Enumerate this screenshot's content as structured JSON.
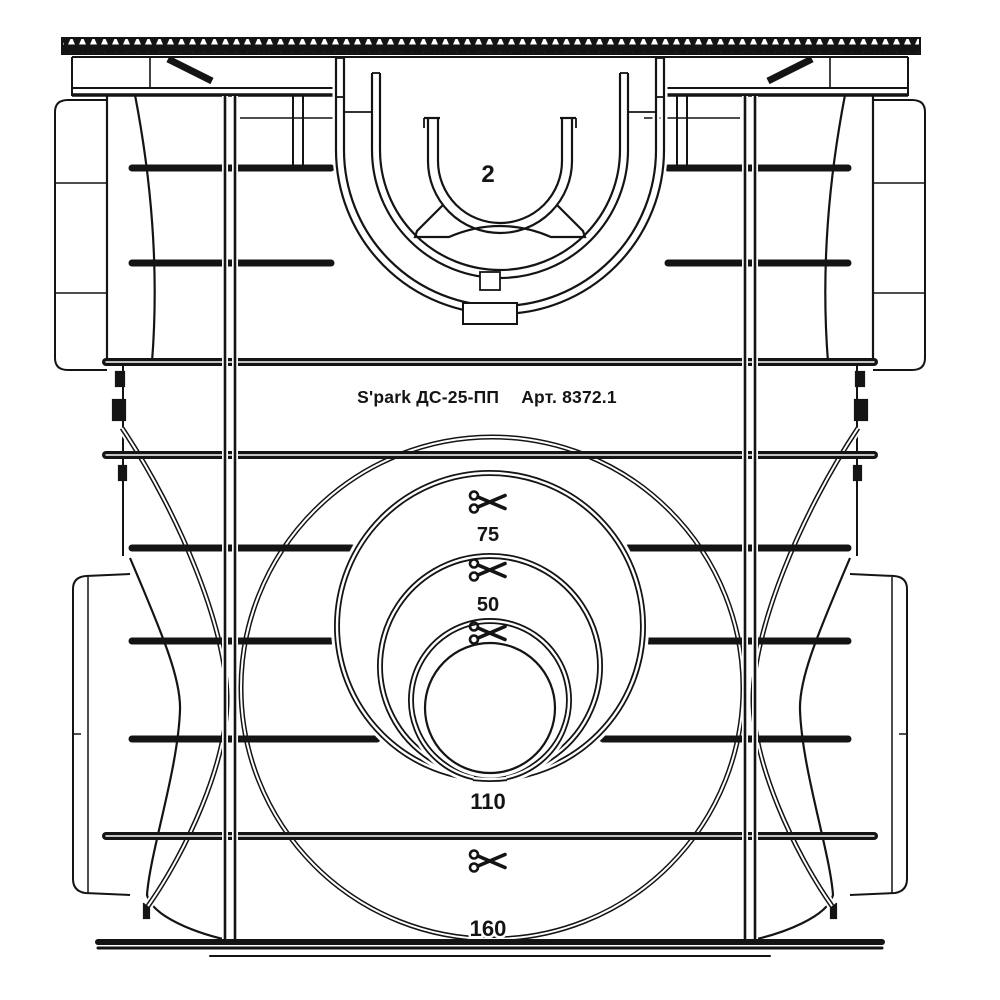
{
  "drawing": {
    "background": "#ffffff",
    "line_color": "#141414",
    "brand_text": "S'park ДС-25-ПП",
    "article_text": "Арт. 8372.1",
    "channel_callout": "2",
    "cut_icon": "scissors",
    "knockouts": {
      "d75": "75",
      "d50": "50",
      "d110": "110",
      "d160": "160"
    }
  }
}
